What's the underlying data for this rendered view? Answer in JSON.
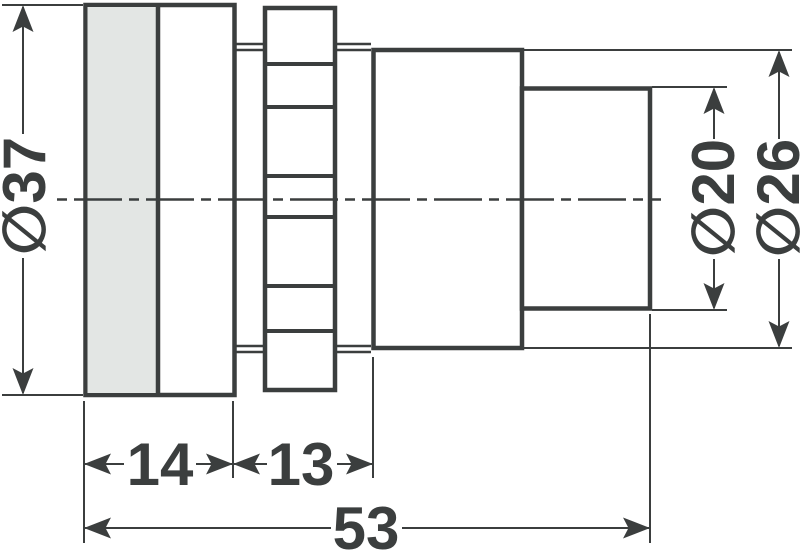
{
  "drawing": {
    "colors": {
      "line": "#3b3e3e",
      "lens_fill": "#e3e6e4",
      "part_fill": "#ffffff",
      "background": "#ffffff"
    },
    "dimensions": {
      "front_diameter": {
        "label": "∅37"
      },
      "front_length": {
        "label": "14"
      },
      "thread_length": {
        "label": "13"
      },
      "overall_length": {
        "label": "53"
      },
      "rear_small_diameter": {
        "label": "∅20"
      },
      "rear_large_diameter": {
        "label": "∅26"
      }
    }
  }
}
